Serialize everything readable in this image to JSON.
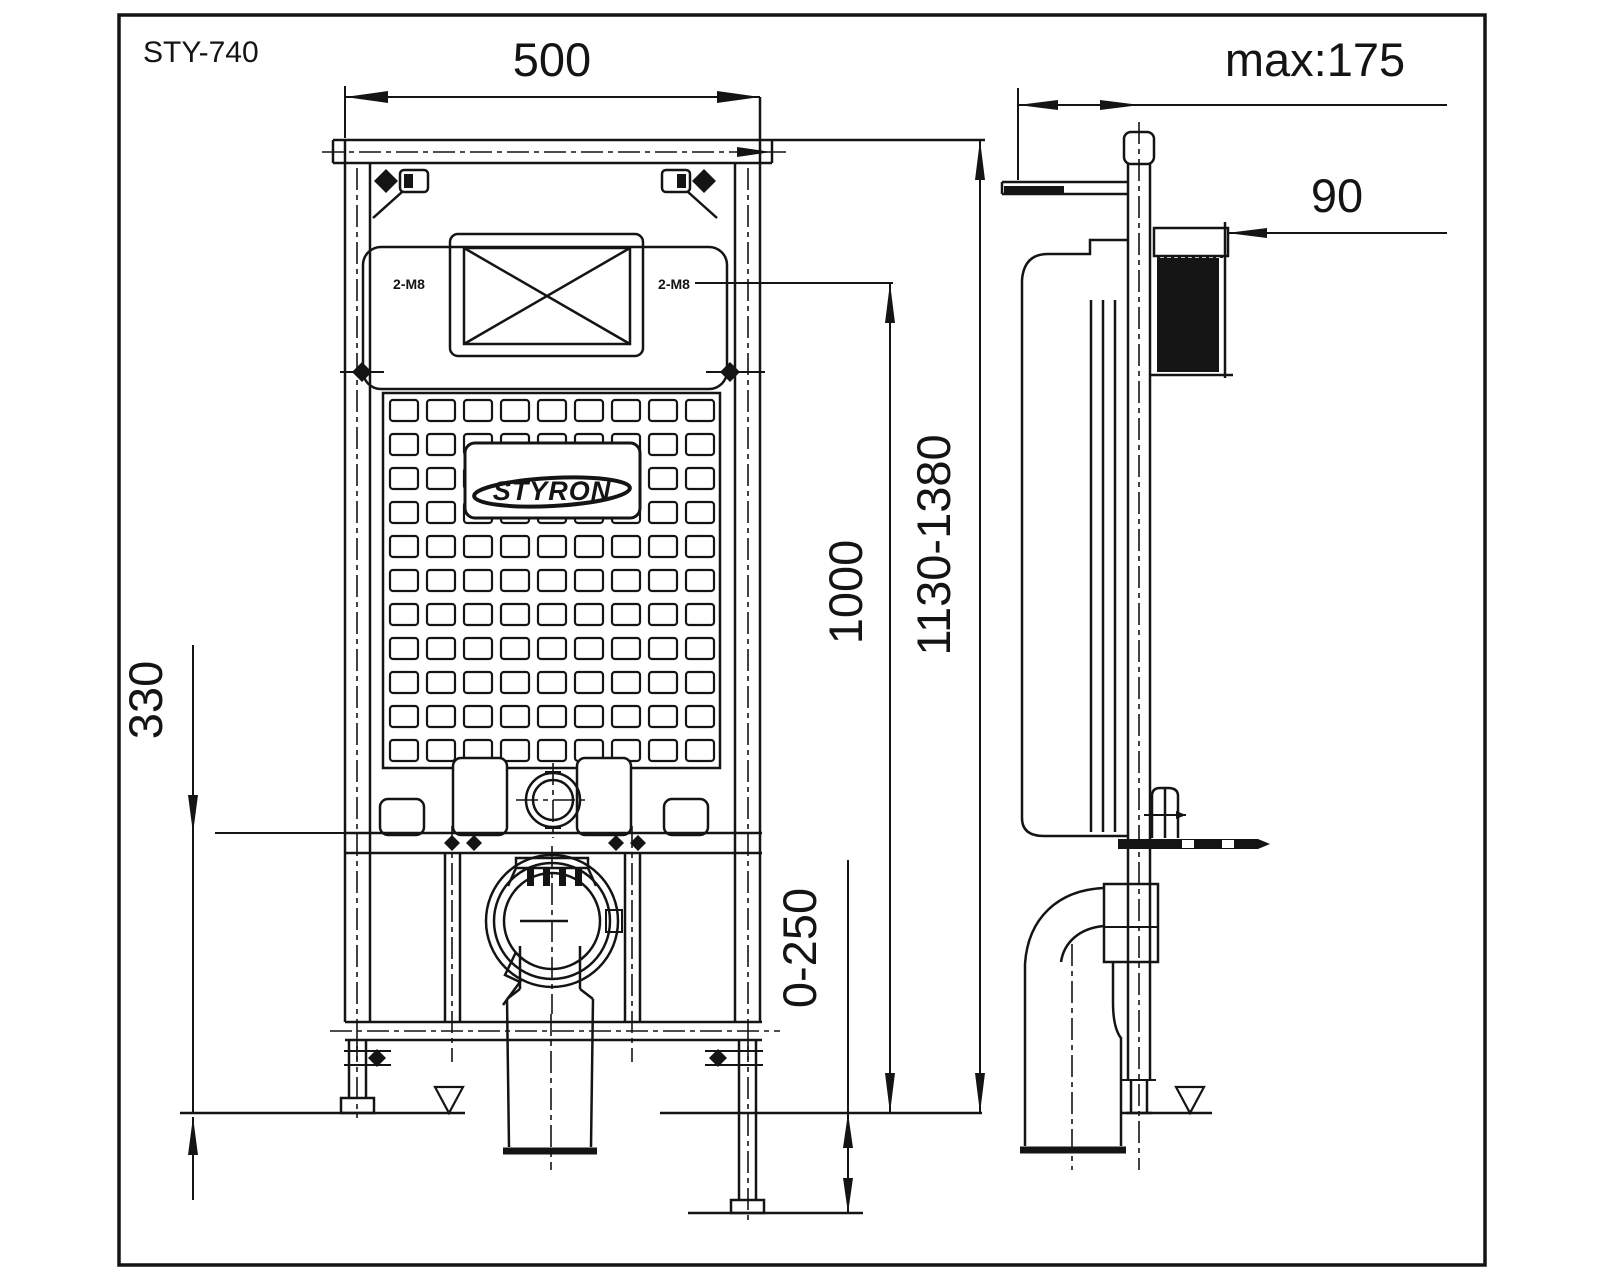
{
  "drawing": {
    "model": "STY-740",
    "brand": "STYRON",
    "dimensions": {
      "frame_width": "500",
      "wall_offset_max": "max:175",
      "flush_unit_depth": "90",
      "lower_bracket_height": "330",
      "flush_line_height": "1000",
      "frame_height_range": "1130-1380",
      "outlet_below_floor_range": "0-250"
    },
    "hole_labels": {
      "left": "2-M8",
      "right": "2-M8"
    }
  }
}
